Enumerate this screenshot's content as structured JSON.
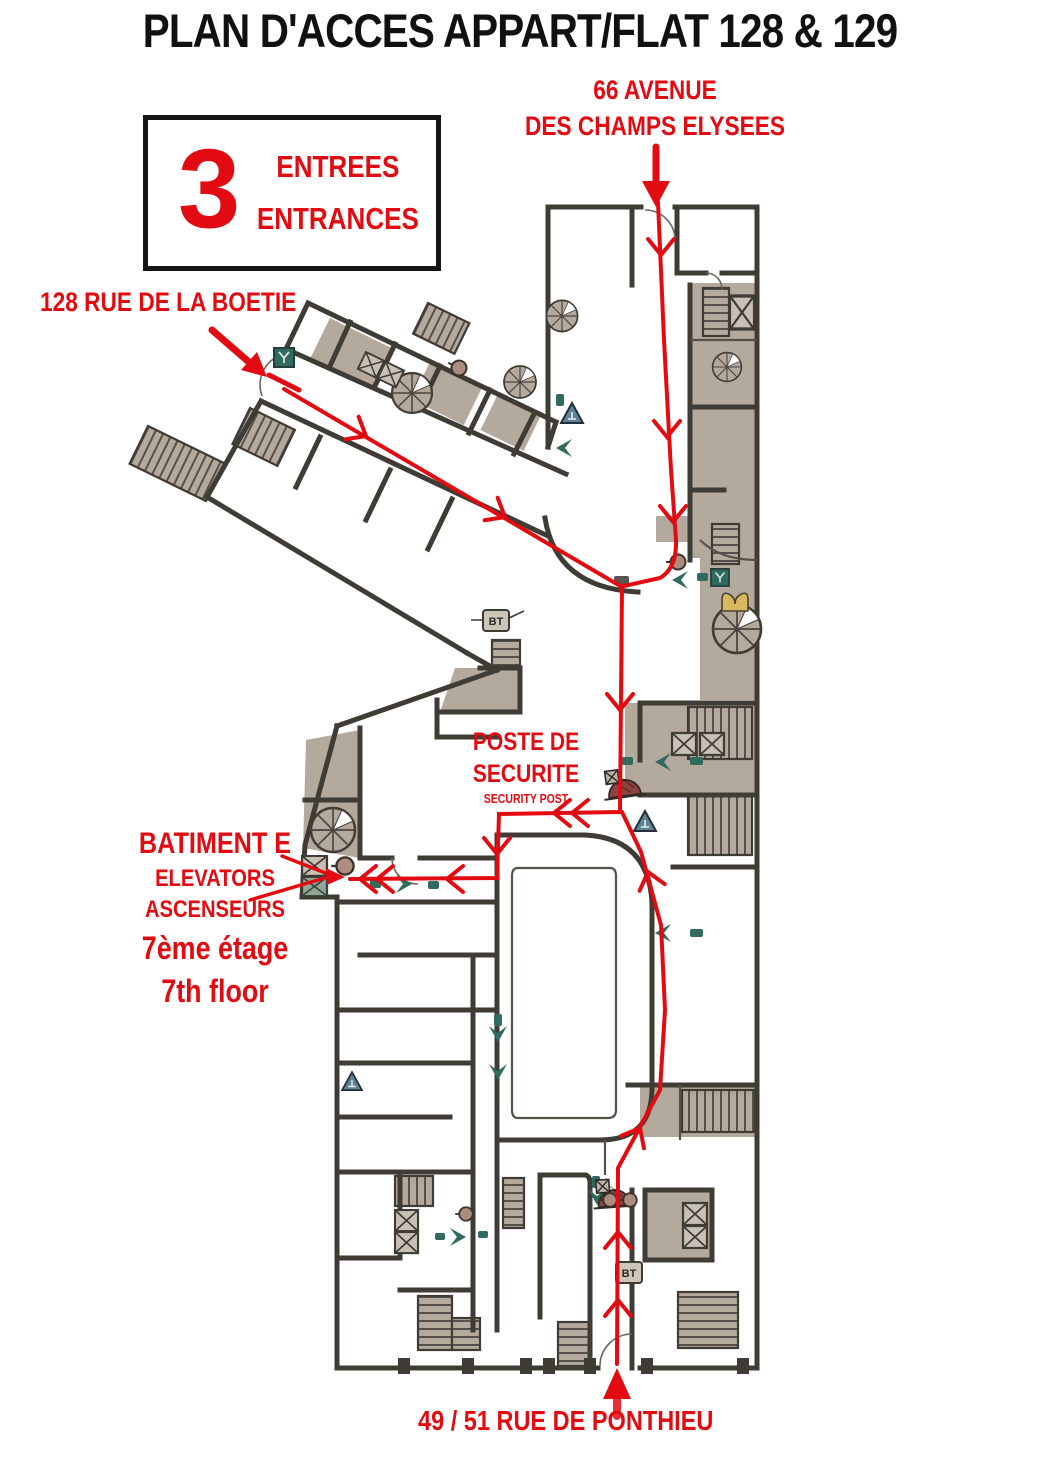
{
  "colors": {
    "red": "#e30b12",
    "wall": "#3f3b35",
    "fill": "#b3aa9d",
    "teal": "#2f6b5e",
    "maroon": "#8e4340",
    "gold": "#d9b85d",
    "blue": "#5f8396",
    "ink": "#111111",
    "paper": "#ffffff"
  },
  "title": "PLAN D'ACCES APPART/FLAT  128 & 129",
  "entranceBox": {
    "count": "3",
    "fr": "ENTREES",
    "en": "ENTRANCES"
  },
  "labels": {
    "avenue1": "66 AVENUE",
    "avenue2": "DES CHAMPS ELYSEES",
    "boetie": "128 RUE DE LA BOETIE",
    "poste1": "POSTE DE",
    "poste2": "SECURITE",
    "poste3": "SECURITY POST",
    "batiment1": "BATIMENT E",
    "batiment2": "ELEVATORS",
    "batiment3": "ASCENSEURS",
    "batiment4": "7ème étage",
    "batiment5": "7th floor",
    "ponthieu": "49 / 51 RUE DE PONTHIEU",
    "bt": "BT"
  }
}
